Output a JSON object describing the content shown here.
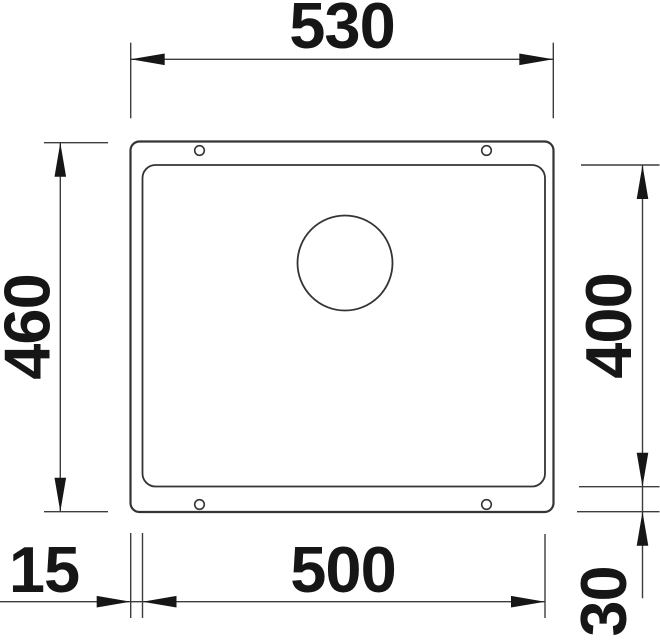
{
  "drawing": {
    "kind": "sink-undermount-dimension-drawing",
    "colors": {
      "ink": "#3d3d3d",
      "outline": "#343434",
      "text_and_arrows": "#161616",
      "background": "#ffffff"
    },
    "dimensions": {
      "overall_width": "530",
      "overall_height": "460",
      "bowl_width": "500",
      "bowl_height": "400",
      "rim_left": "15",
      "rim_bottom": "30"
    }
  }
}
